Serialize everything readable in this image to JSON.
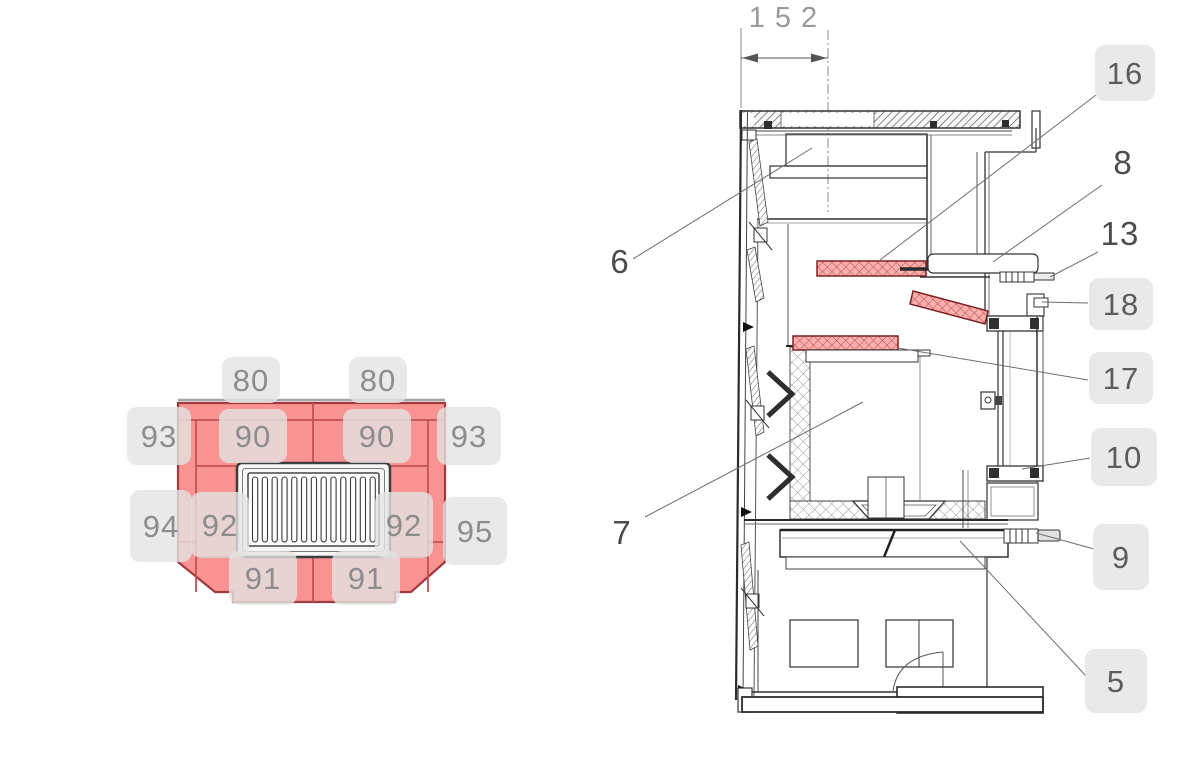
{
  "title": "Stove spare-part diagram",
  "colors": {
    "panel_fill": "#f99392",
    "panel_stroke": "#a03a3e",
    "panel_divider": "#c25054",
    "red_hatch_fill": "#f7b0ae",
    "red_hatch_line": "#c4504e",
    "label_bg": "#e3e3e3",
    "label_text_front": "#8d8d8d",
    "label_text_side": "#4c4c4c",
    "drawing_line": "#333333"
  },
  "front_view": {
    "name": "Firebox lining front view",
    "labels": [
      {
        "id": "80-left",
        "text": "80"
      },
      {
        "id": "80-right",
        "text": "80"
      },
      {
        "id": "93-left",
        "text": "93"
      },
      {
        "id": "90-left",
        "text": "90"
      },
      {
        "id": "90-right",
        "text": "90"
      },
      {
        "id": "93-right",
        "text": "93"
      },
      {
        "id": "94",
        "text": "94"
      },
      {
        "id": "92-left",
        "text": "92"
      },
      {
        "id": "92-right",
        "text": "92"
      },
      {
        "id": "95",
        "text": "95"
      },
      {
        "id": "91-left",
        "text": "91"
      },
      {
        "id": "91-right",
        "text": "91"
      }
    ]
  },
  "side_view": {
    "name": "Stove cross-section side view",
    "dimension_label": "152",
    "callouts": [
      {
        "id": "16",
        "text": "16",
        "boxed": true
      },
      {
        "id": "8",
        "text": "8",
        "boxed": false
      },
      {
        "id": "13",
        "text": "13",
        "boxed": false
      },
      {
        "id": "18",
        "text": "18",
        "boxed": true
      },
      {
        "id": "17",
        "text": "17",
        "boxed": true
      },
      {
        "id": "10",
        "text": "10",
        "boxed": true
      },
      {
        "id": "9",
        "text": "9",
        "boxed": true
      },
      {
        "id": "5",
        "text": "5",
        "boxed": true
      },
      {
        "id": "6",
        "text": "6",
        "boxed": false
      },
      {
        "id": "7",
        "text": "7",
        "boxed": false
      }
    ]
  }
}
